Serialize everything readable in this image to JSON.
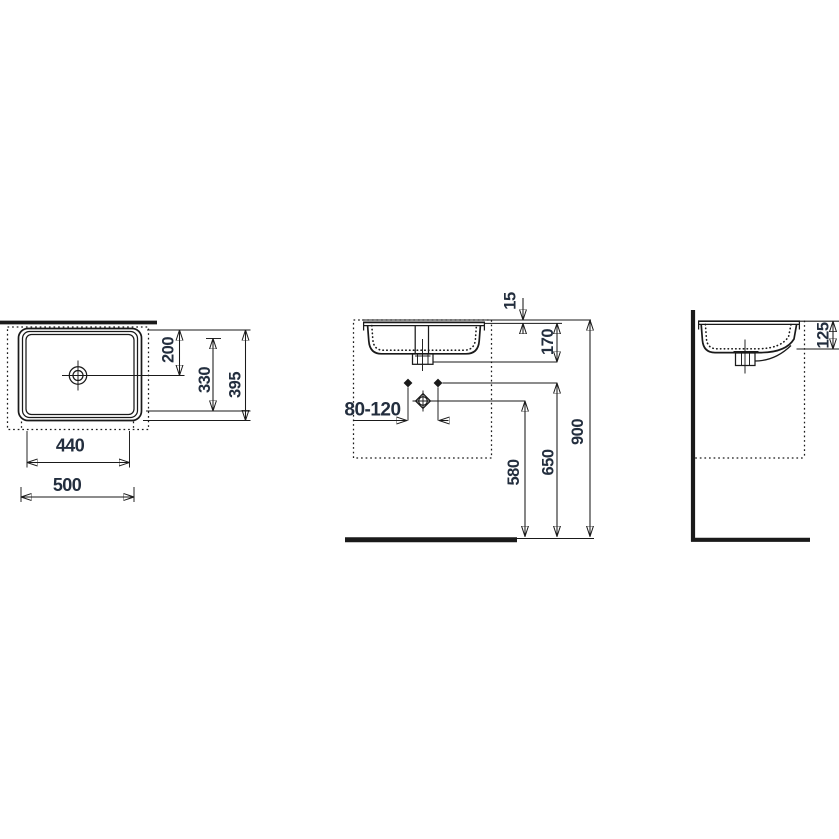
{
  "colors": {
    "line": "#1a1a1a",
    "text": "#232e3e",
    "background": "#ffffff"
  },
  "views": {
    "top": {
      "dims": {
        "d200": "200",
        "d330": "330",
        "d395": "395",
        "d440": "440",
        "d500": "500"
      }
    },
    "front": {
      "dims": {
        "d15": "15",
        "d170": "170",
        "d80_120": "80-120",
        "d580": "580",
        "d650": "650",
        "d900": "900"
      }
    },
    "side": {
      "dims": {
        "d125": "125"
      }
    }
  }
}
